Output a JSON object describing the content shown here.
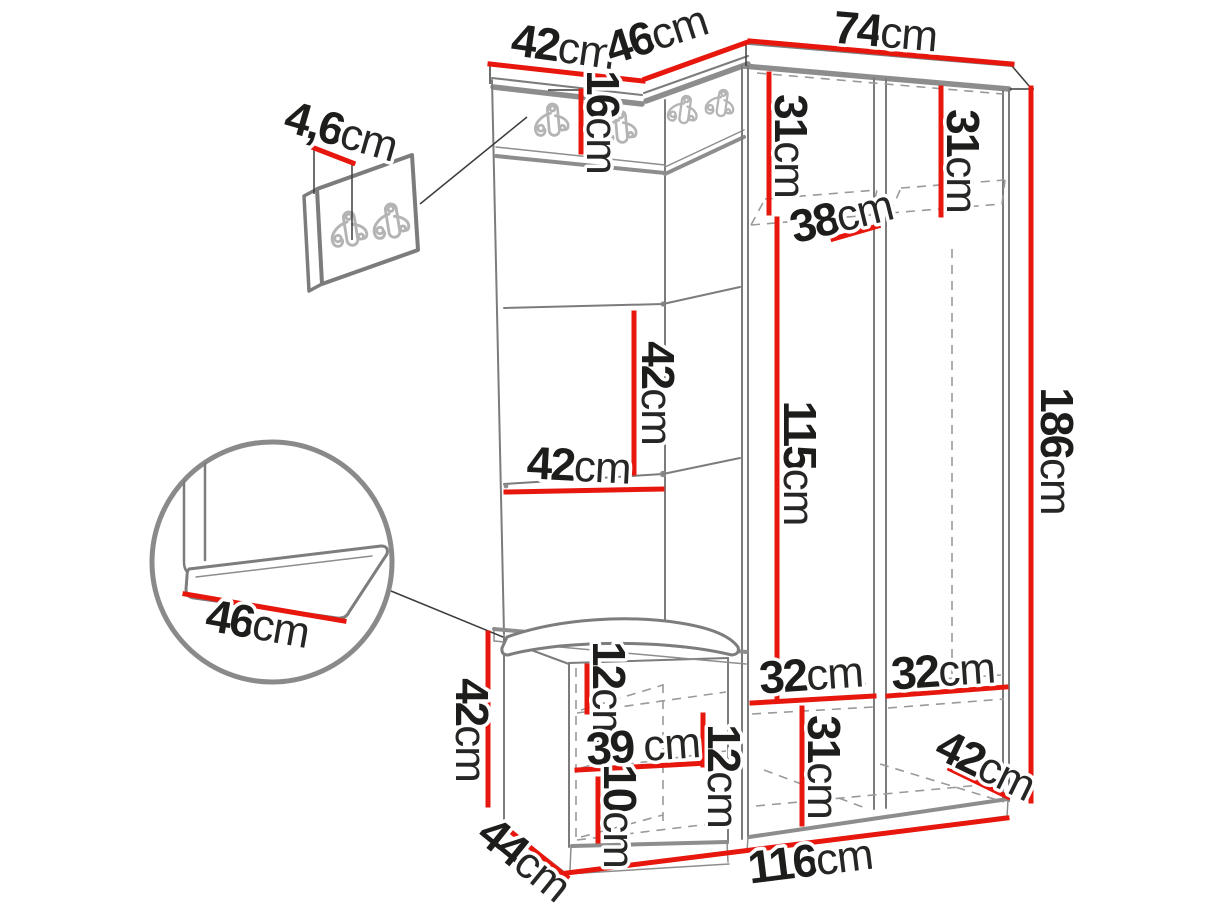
{
  "diagram": {
    "kind": "furniture-dimension-diagram",
    "subject": "hallway set: hook panels, wardrobe and bench with cushion",
    "measurement_unit": "cm"
  },
  "style": {
    "dimension_line_color": "#e7170e",
    "furniture_line_color": "#8d8d8d",
    "dashed_line_color": "#9a9a9a",
    "text_color": "#1d1d1b",
    "background_color": "#ffffff"
  },
  "icons": {
    "coat_hook": "double-prong-coat-hook"
  },
  "dimensions": [
    {
      "id": "panel-top-width",
      "value": "42",
      "unit": "cm"
    },
    {
      "id": "corner-top-width",
      "value": "46",
      "unit": "cm"
    },
    {
      "id": "wardrobe-top-width",
      "value": "74",
      "unit": "cm"
    },
    {
      "id": "hook-strip-height",
      "value": "16",
      "unit": "cm"
    },
    {
      "id": "wall-panel-thickness",
      "value": "4,6",
      "unit": "cm"
    },
    {
      "id": "left-top-shelf-height",
      "value": "31",
      "unit": "cm"
    },
    {
      "id": "right-top-shelf-height",
      "value": "31",
      "unit": "cm"
    },
    {
      "id": "top-shelf-depth",
      "value": "38",
      "unit": "cm"
    },
    {
      "id": "total-height",
      "value": "186",
      "unit": "cm"
    },
    {
      "id": "panel-square-height",
      "value": "42",
      "unit": "cm"
    },
    {
      "id": "panel-square-width",
      "value": "42",
      "unit": "cm"
    },
    {
      "id": "hanging-space-height",
      "value": "115",
      "unit": "cm"
    },
    {
      "id": "seat-cushion-width",
      "value": "46",
      "unit": "cm"
    },
    {
      "id": "bench-height",
      "value": "42",
      "unit": "cm"
    },
    {
      "id": "bench-depth",
      "value": "44",
      "unit": "cm"
    },
    {
      "id": "bench-top-clearance",
      "value": "12",
      "unit": "cm"
    },
    {
      "id": "bench-shelf-width",
      "value": "39",
      "unit": "cm"
    },
    {
      "id": "bench-middle-clearance",
      "value": "12",
      "unit": "cm"
    },
    {
      "id": "bench-bottom-clearance",
      "value": "10",
      "unit": "cm"
    },
    {
      "id": "left-bottom-shelf-width",
      "value": "32",
      "unit": "cm"
    },
    {
      "id": "right-bottom-shelf-width",
      "value": "32",
      "unit": "cm"
    },
    {
      "id": "bottom-compartment-height",
      "value": "31",
      "unit": "cm"
    },
    {
      "id": "wardrobe-bottom-depth",
      "value": "42",
      "unit": "cm"
    },
    {
      "id": "total-width",
      "value": "116",
      "unit": "cm"
    }
  ]
}
